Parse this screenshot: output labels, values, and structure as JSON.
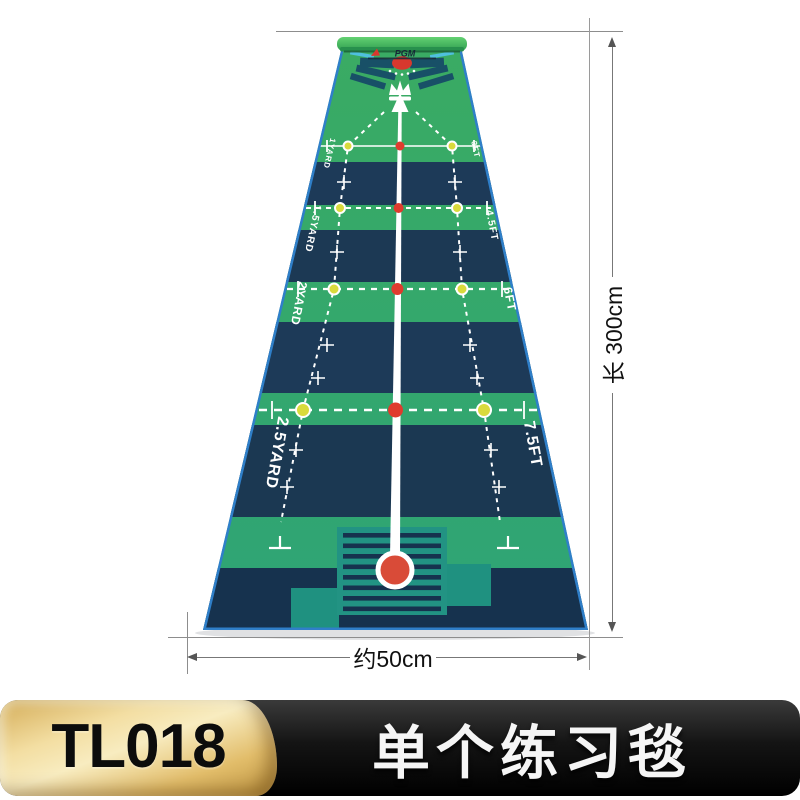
{
  "product": {
    "model_code": "TL018",
    "title": "单个练习毯"
  },
  "dimension_annotations": {
    "length_label": "长 300cm",
    "width_label": "约50cm"
  },
  "mat": {
    "brand_logo": "PGM",
    "distance_markers": [
      {
        "left_yards": "1YARD",
        "right_feet": "3FT"
      },
      {
        "left_yards": "1.5YARD",
        "right_feet": "4.5FT"
      },
      {
        "left_yards": "2YARD",
        "right_feet": "6FT"
      },
      {
        "left_yards": "2.5YARD",
        "right_feet": "7.5FT"
      }
    ],
    "colors": {
      "surface_green": "#2fa36e",
      "band_navy": "#1d3a58",
      "bottom_teal": "#229383",
      "edge_blue": "#2f7fc9",
      "roll_green": "#4ec368",
      "hole_red": "#d8382e",
      "ball_red": "#d94b38",
      "dot_yellow": "#d9da3c",
      "center_line": "#ffffff"
    }
  },
  "banner": {
    "gold_badge_color": "#e9c979",
    "black_bar_color": "#0d0d0d"
  }
}
